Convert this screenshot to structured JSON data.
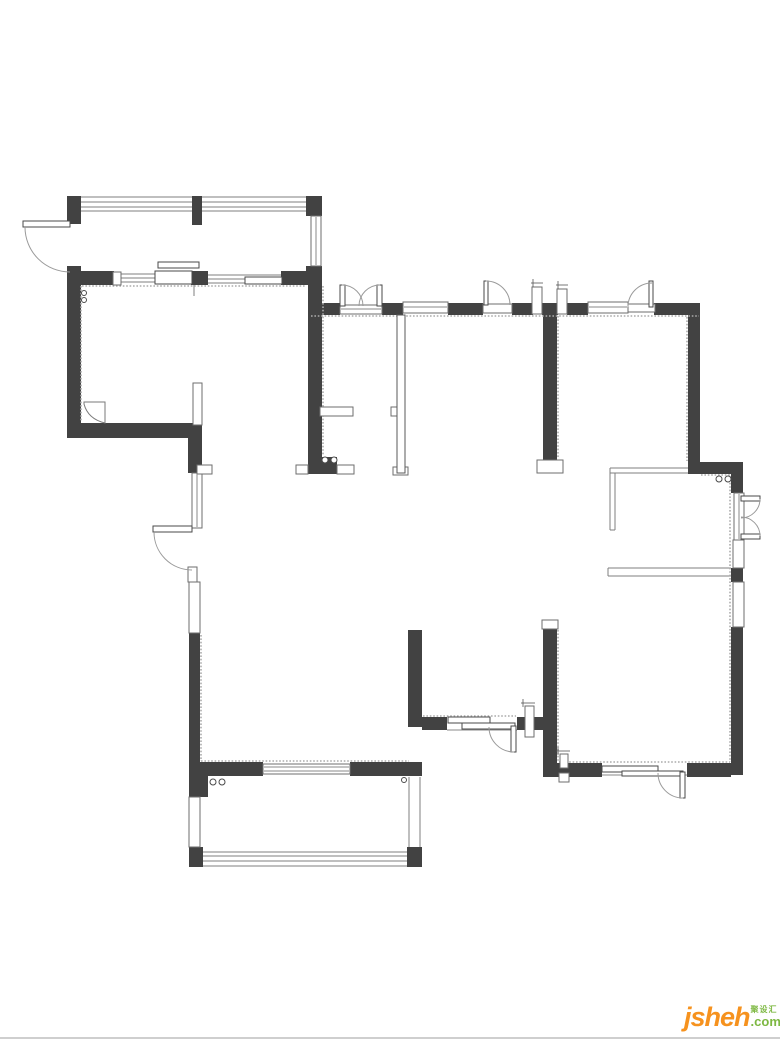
{
  "page": {
    "background": "#ffffff",
    "footer_line": {
      "color": "#cfcfcf",
      "y": 1037
    }
  },
  "logo": {
    "brand": "jsheh",
    "tld": ".com",
    "tagline": "聚设汇",
    "brand_color": "#f6921e",
    "accent_color": "#7db842",
    "x": 684,
    "y": 1004
  },
  "floorplan": {
    "canvas": {
      "width": 780,
      "height": 1040
    },
    "colors": {
      "wall": "#424242",
      "line": "#7f7f7f",
      "arc": "#9a9a9a",
      "hatch": "#ababab"
    },
    "strip_lines": [
      [
        81,
        197,
        306,
        197
      ],
      [
        81,
        202,
        306,
        202
      ],
      [
        81,
        207,
        306,
        207
      ],
      [
        81,
        211,
        306,
        211
      ],
      [
        121,
        274,
        155,
        274
      ],
      [
        121,
        278,
        155,
        278
      ],
      [
        121,
        282,
        155,
        282
      ],
      [
        208,
        275,
        281,
        275
      ],
      [
        208,
        279,
        281,
        279
      ],
      [
        208,
        283,
        281,
        283
      ],
      [
        203,
        852,
        407,
        852
      ],
      [
        203,
        856,
        407,
        856
      ],
      [
        203,
        861,
        407,
        861
      ],
      [
        203,
        866,
        407,
        866
      ],
      [
        409,
        777,
        409,
        848
      ],
      [
        420,
        777,
        420,
        848
      ],
      [
        610,
        468,
        692,
        468
      ],
      [
        610,
        473,
        692,
        473
      ],
      [
        692,
        468,
        692,
        473
      ],
      [
        610,
        468,
        610,
        530
      ],
      [
        615,
        473,
        615,
        530
      ],
      [
        610,
        530,
        615,
        530
      ],
      [
        608,
        568,
        731,
        568
      ],
      [
        608,
        576,
        731,
        576
      ],
      [
        608,
        568,
        608,
        576
      ],
      [
        194,
        285,
        194,
        296
      ]
    ],
    "walls": [
      [
        67,
        196,
        14,
        28
      ],
      [
        67,
        266,
        14,
        20
      ],
      [
        192,
        196,
        10,
        29
      ],
      [
        306,
        196,
        16,
        20
      ],
      [
        67,
        285,
        14,
        152
      ],
      [
        67,
        423,
        131,
        15
      ],
      [
        188,
        425,
        14,
        48
      ],
      [
        70,
        271,
        44,
        14
      ],
      [
        191,
        271,
        17,
        14
      ],
      [
        281,
        271,
        41,
        14
      ],
      [
        306,
        266,
        16,
        19
      ],
      [
        308,
        285,
        14,
        172
      ],
      [
        308,
        457,
        29,
        17
      ],
      [
        310,
        303,
        30,
        12
      ],
      [
        382,
        303,
        21,
        12
      ],
      [
        448,
        303,
        35,
        12
      ],
      [
        512,
        303,
        21,
        12
      ],
      [
        542,
        303,
        16,
        12
      ],
      [
        567,
        303,
        21,
        12
      ],
      [
        654,
        303,
        46,
        12
      ],
      [
        543,
        315,
        14,
        145
      ],
      [
        688,
        315,
        12,
        147
      ],
      [
        688,
        462,
        55,
        12
      ],
      [
        731,
        474,
        12,
        19
      ],
      [
        731,
        568,
        12,
        14
      ],
      [
        731,
        627,
        12,
        148
      ],
      [
        687,
        763,
        44,
        14
      ],
      [
        543,
        763,
        59,
        14
      ],
      [
        543,
        625,
        14,
        140
      ],
      [
        517,
        717,
        28,
        13
      ],
      [
        422,
        717,
        25,
        13
      ],
      [
        408,
        630,
        14,
        97
      ],
      [
        189,
        762,
        74,
        14
      ],
      [
        350,
        762,
        72,
        14
      ],
      [
        189,
        633,
        11,
        132
      ],
      [
        189,
        765,
        19,
        32
      ],
      [
        189,
        847,
        14,
        20
      ],
      [
        407,
        847,
        15,
        20
      ]
    ],
    "hatch_lines": [
      [
        82,
        286,
        306,
        286
      ],
      [
        311,
        316,
        699,
        316
      ],
      [
        687,
        317,
        687,
        461
      ],
      [
        701,
        475,
        730,
        475
      ],
      [
        730,
        476,
        730,
        762
      ],
      [
        558,
        316,
        558,
        458
      ],
      [
        558,
        630,
        558,
        762
      ],
      [
        559,
        762,
        730,
        762
      ],
      [
        423,
        716,
        516,
        716
      ],
      [
        201,
        761,
        409,
        761
      ],
      [
        201,
        635,
        201,
        761
      ],
      [
        323,
        286,
        323,
        456
      ],
      [
        81,
        286,
        81,
        422
      ]
    ],
    "windows": [
      [
        311,
        216,
        10,
        50
      ],
      [
        403,
        302,
        45,
        11
      ],
      [
        588,
        302,
        40,
        11
      ],
      [
        192,
        473,
        10,
        55
      ],
      [
        189,
        582,
        11,
        51
      ],
      [
        189,
        797,
        11,
        50
      ],
      [
        193,
        383,
        9,
        42
      ],
      [
        734,
        493,
        10,
        47
      ],
      [
        733,
        540,
        11,
        28
      ],
      [
        733,
        582,
        11,
        45
      ],
      [
        537,
        460,
        26,
        13
      ],
      [
        542,
        620,
        16,
        9
      ],
      [
        263,
        764,
        87,
        10
      ],
      [
        532,
        287,
        10,
        27
      ],
      [
        557,
        289,
        10,
        25
      ],
      [
        525,
        706,
        9,
        31
      ],
      [
        560,
        754,
        8,
        14
      ],
      [
        559,
        773,
        10,
        9
      ],
      [
        320,
        407,
        33,
        9
      ],
      [
        391,
        407,
        7,
        9
      ],
      [
        296,
        465,
        12,
        9
      ],
      [
        337,
        465,
        17,
        9
      ],
      [
        393,
        467,
        15,
        8
      ],
      [
        197,
        465,
        15,
        9
      ],
      [
        340,
        305,
        42,
        9
      ],
      [
        483,
        304,
        29,
        9
      ],
      [
        628,
        304,
        27,
        8
      ],
      [
        113,
        272,
        8,
        13
      ],
      [
        188,
        567,
        9,
        15
      ]
    ],
    "thin_walls": [
      [
        397,
        315,
        8,
        158
      ]
    ],
    "mullion_lines": [
      [
        316,
        217,
        316,
        265
      ],
      [
        404,
        307,
        447,
        307
      ],
      [
        589,
        307,
        627,
        307
      ],
      [
        197,
        474,
        197,
        527
      ],
      [
        341,
        309,
        381,
        309
      ],
      [
        264,
        767,
        349,
        767
      ],
      [
        264,
        771,
        349,
        771
      ],
      [
        447,
        730,
        517,
        730
      ],
      [
        602,
        775,
        687,
        775
      ],
      [
        739,
        494,
        739,
        539
      ]
    ],
    "door_panels": [
      [
        155,
        271,
        37,
        13
      ],
      [
        158,
        262,
        41,
        6
      ],
      [
        245,
        277,
        37,
        7
      ],
      [
        448,
        717,
        42,
        6
      ],
      [
        462,
        723,
        53,
        6
      ],
      [
        602,
        766,
        56,
        6
      ],
      [
        622,
        771,
        61,
        5
      ],
      [
        23,
        221,
        47,
        6
      ],
      [
        153,
        526,
        39,
        6
      ],
      [
        340,
        285,
        5,
        21
      ],
      [
        377,
        285,
        5,
        21
      ],
      [
        484,
        281,
        4,
        24
      ],
      [
        649,
        281,
        4,
        26
      ],
      [
        741,
        496,
        19,
        5
      ],
      [
        741,
        534,
        19,
        5
      ],
      [
        511,
        726,
        5,
        26
      ],
      [
        680,
        772,
        5,
        26
      ]
    ],
    "door_arcs": [
      "M25,227 A45,45 0 0 0 70,272",
      "M154,532 A38,38 0 0 0 192,570",
      "M342,285 A21,21 0 0 1 363,306",
      "M380,285 A21,21 0 0 0 359,306",
      "M486,281 A24,24 0 0 1 510,305",
      "M652,283 A24,24 0 0 0 628,307",
      "M760,499 A19,19 0 0 1 741,518",
      "M760,536 A19,19 0 0 0 741,517",
      "M489,727 A25,25 0 0 0 514,752",
      "M658,773 A25,25 0 0 0 683,798"
    ],
    "fixtures": [
      "M84,402 L105,402 L105,423 Q88,419 84,404 Z"
    ],
    "pipe_glyphs": [
      [
        531,
        283,
        543,
        283
      ],
      [
        533,
        279,
        533,
        287
      ],
      [
        556,
        285,
        568,
        285
      ],
      [
        558,
        281,
        558,
        289
      ],
      [
        521,
        703,
        535,
        703
      ],
      [
        523,
        699,
        523,
        707
      ],
      [
        556,
        751,
        570,
        751
      ],
      [
        558,
        747,
        558,
        755
      ]
    ],
    "drain_circles": [
      [
        84,
        293,
        2.5
      ],
      [
        84,
        300,
        2.5
      ],
      [
        325,
        460,
        3
      ],
      [
        334,
        460,
        3
      ],
      [
        719,
        479,
        3
      ],
      [
        728,
        479,
        3
      ],
      [
        213,
        782,
        3
      ],
      [
        222,
        782,
        3
      ],
      [
        404,
        780,
        2.5
      ]
    ]
  }
}
